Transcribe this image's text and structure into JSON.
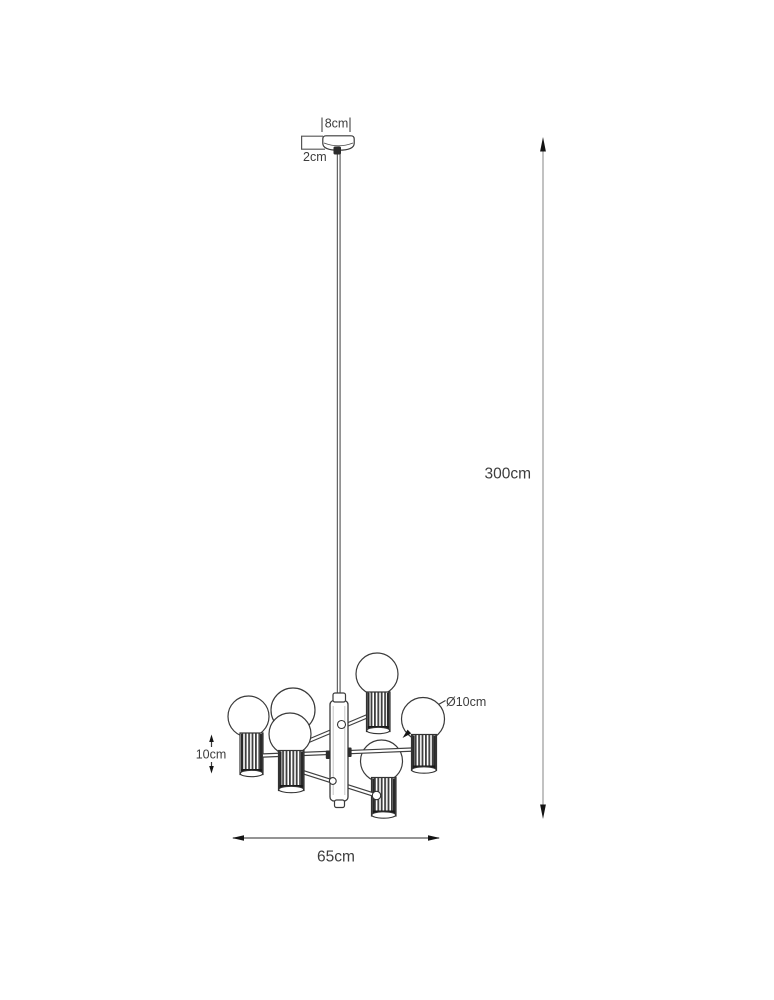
{
  "labels": {
    "canopy_width": "8cm",
    "canopy_height": "2cm",
    "suspension_height": "300cm",
    "globe_diameter": "Ø10cm",
    "socket_height": "10cm",
    "fixture_width": "65cm"
  },
  "colors": {
    "background": "#ffffff",
    "line": "#3a3a3a",
    "dimension_line": "#9e9e9e",
    "arrow": "#141414",
    "text": "#3d3d3d"
  }
}
